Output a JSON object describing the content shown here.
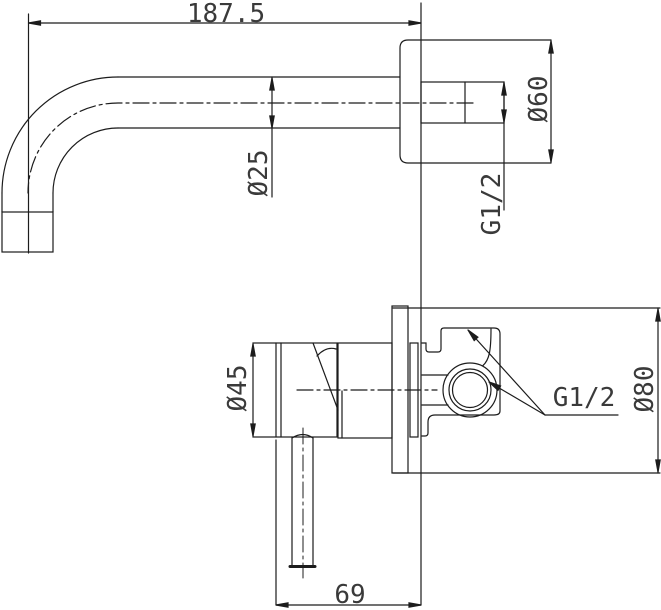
{
  "drawing": {
    "type": "technical-dimension-drawing",
    "subject": "wall-mounted basin mixer tap - spout and concealed valve side views",
    "colors": {
      "background": "#ffffff",
      "line": "#1c1c1c",
      "dim_text": "#3a3a3a"
    }
  },
  "labels": {
    "spout_reach": "187.5",
    "spout_diameter": "Ø25",
    "flange_diameter": "Ø60",
    "spout_inlet_thread": "G1/2",
    "handle_trim_diameter": "Ø45",
    "valve_port_thread": "G1/2",
    "wall_plate_diameter": "Ø80",
    "trim_depth": "69"
  }
}
